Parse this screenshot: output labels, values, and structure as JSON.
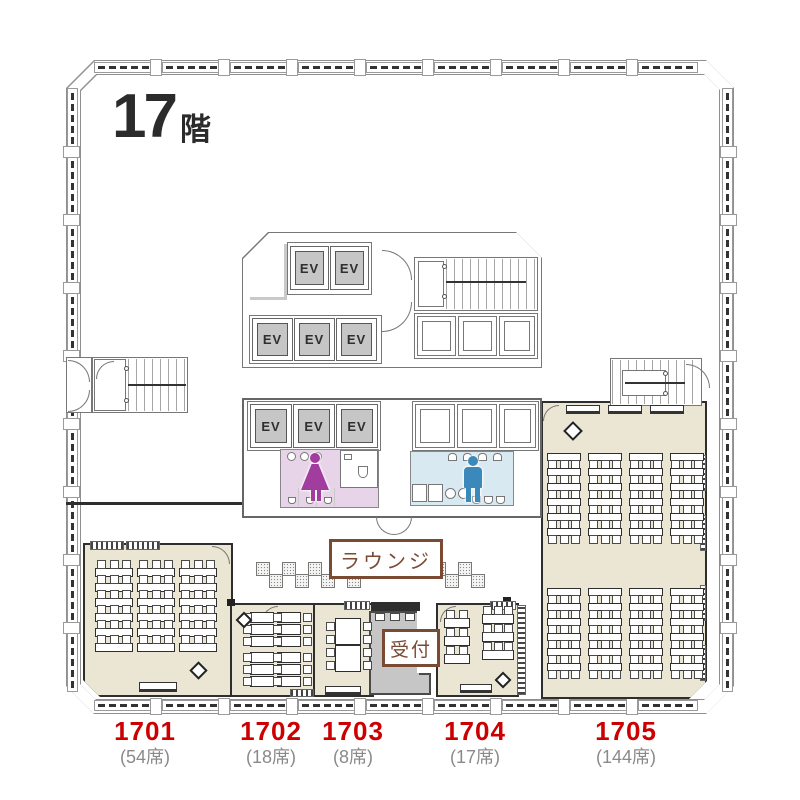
{
  "floor_plan": {
    "title": {
      "number": "17",
      "suffix": "階"
    },
    "core": {
      "elevator_label": "EV"
    },
    "amenities": {
      "lounge_label": "ラウンジ",
      "reception_label": "受付",
      "womens_restroom_icon": "female-figure",
      "mens_restroom_icon": "male-figure"
    },
    "rooms": [
      {
        "number": "1701",
        "seats": "(54席)"
      },
      {
        "number": "1702",
        "seats": "(18席)"
      },
      {
        "number": "1703",
        "seats": "(8席)"
      },
      {
        "number": "1704",
        "seats": "(17席)"
      },
      {
        "number": "1705",
        "seats": "(144席)"
      }
    ],
    "colors": {
      "room_fill": "#ebe5d3",
      "womens_fill": "#e8d4e8",
      "womens_icon": "#a13d9f",
      "mens_fill": "#d9e9f2",
      "mens_icon": "#3b89ba",
      "elevator_fill": "#c6c6c6",
      "reception_fill": "#c6c6c6",
      "accent_brown": "#7a4a33",
      "room_number_red": "#cc0000",
      "seat_count_gray": "#8a8a8a"
    }
  }
}
